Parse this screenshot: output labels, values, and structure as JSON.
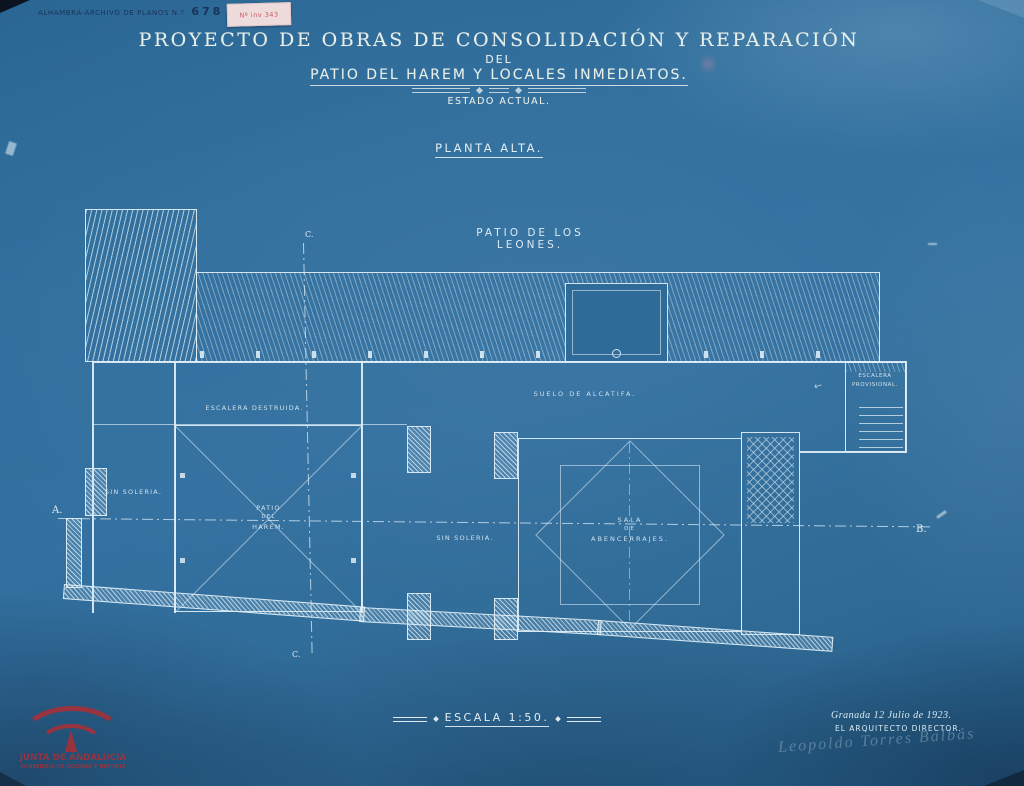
{
  "colors": {
    "paper_blue": "#2e6b98",
    "line_white": "#dcecf4",
    "stamp_red": "#c0444c",
    "note_pink": "#eedcdd",
    "ink_dark": "#17294d"
  },
  "stamp": {
    "archive": "ALHAMBRA-ARCHIVO DE PLANOS N.º",
    "number": "678",
    "suffix": "Original",
    "note": "Nº inv 343"
  },
  "title": {
    "line1": "PROYECTO DE OBRAS DE CONSOLIDACIÓN Y REPARACIÓN",
    "line2": "DEL",
    "line3": "PATIO DEL HAREM Y LOCALES INMEDIATOS.",
    "state": "ESTADO ACTUAL.",
    "floor": "PLANTA ALTA."
  },
  "plan": {
    "patio_leones": "PATIO DE LOS LEONES.",
    "escalera_destruida": "ESCALERA DESTRUIDA.",
    "sin_soleria_left": "SIN SOLERIA.",
    "sin_soleria_mid": "SIN SOLERIA.",
    "suelo_alcatifa": "SUELO DE ALCATIFA.",
    "harem": [
      "PATIO",
      "DEL",
      "HAREM."
    ],
    "sala": [
      "SALA",
      "DE",
      "ABENCERRAJES."
    ],
    "escalera_provisional": [
      "ESCALERA",
      "PROVISIONAL."
    ],
    "sections": {
      "a": "A.",
      "b": "B.",
      "c_top": "C.",
      "c_bottom": "C."
    }
  },
  "footer": {
    "scale": "ESCALA 1:50.",
    "date": "Granada 12 Julio de 1923.",
    "role": "EL ARQUITECTO DIRECTOR.",
    "signature": "Leopoldo Torres Balbás",
    "logo": {
      "line1": "JUNTA DE ANDALUCIA",
      "line2": "CONSEJERÍA DE CULTURA Y DEPORTE"
    }
  }
}
